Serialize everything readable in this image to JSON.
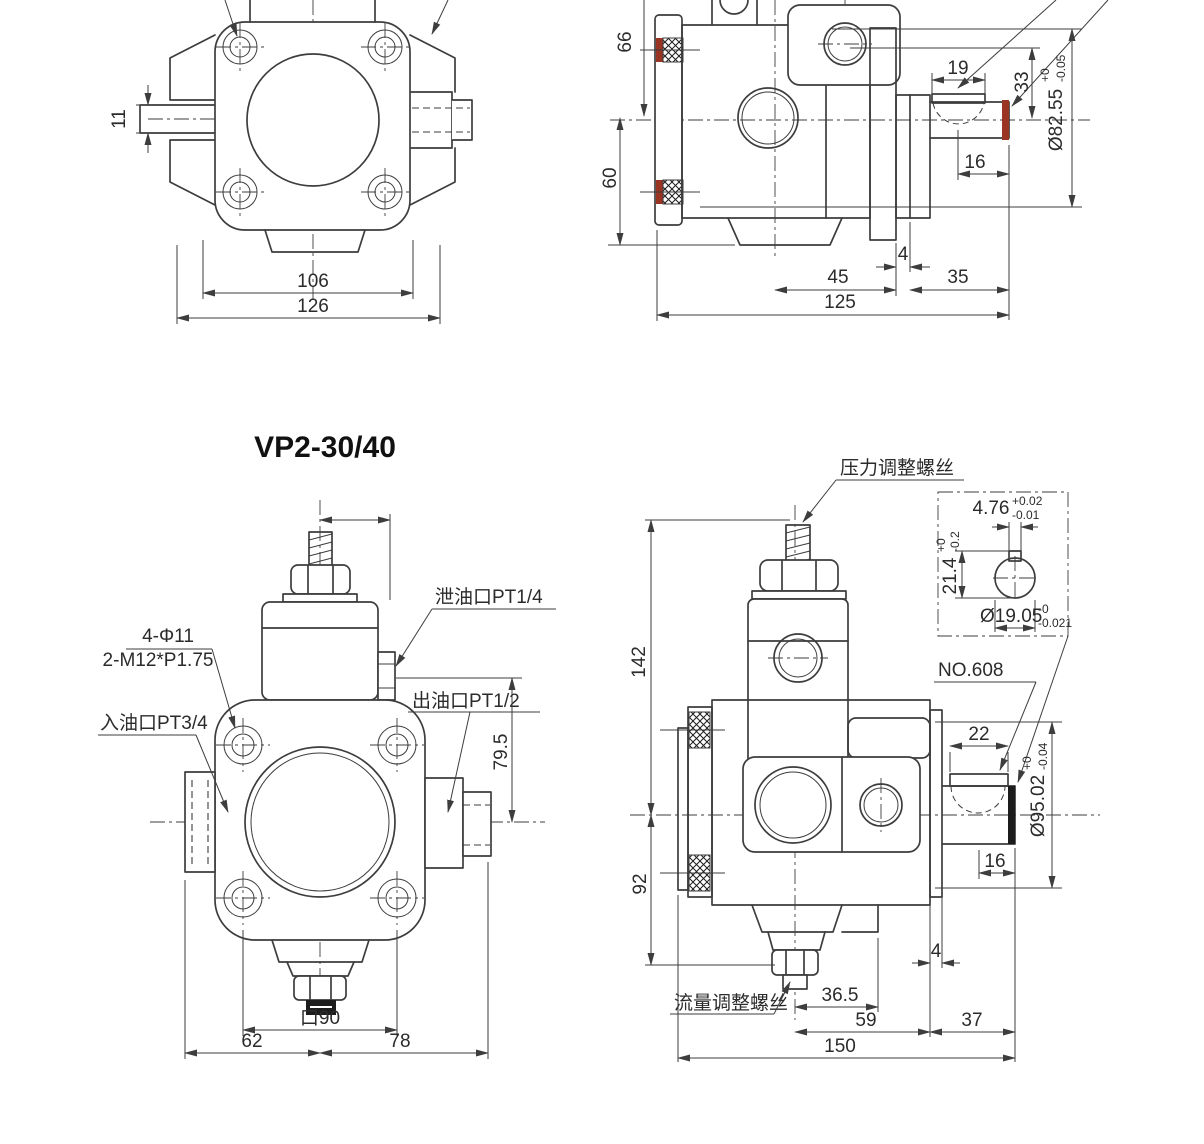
{
  "title": "VP2-30/40",
  "colors": {
    "line": "#3d3d3d",
    "text": "#2b2b2b",
    "seal_red": "#993522",
    "hatch_black": "#1c1c1c",
    "background": "#ffffff"
  },
  "views": {
    "top_front": {
      "dims": {
        "stub_height": "11",
        "flange_width": "106",
        "overall_width": "126"
      }
    },
    "top_side": {
      "dims": {
        "upper_height": "66",
        "lower_height": "60",
        "key_length": "19",
        "key_height": "33",
        "key_to_end": "16",
        "center_to_rear": "45",
        "rear_cover": "4",
        "shaft_ext": "35",
        "overall_length": "125"
      },
      "pilot_dia": {
        "value": "Ø82.55",
        "tol_upper": "+0",
        "tol_lower": "-0.05"
      }
    },
    "bottom_front": {
      "labels": {
        "drain_port": "泄油口PT1/4",
        "mount_holes": "4-Φ11",
        "mount_threads": "2-M12*P1.75",
        "inlet_port": "入油口PT3/4",
        "outlet_port": "出油口PT1/2"
      },
      "dims": {
        "port_to_center": "79.5",
        "bolt_square": "口90",
        "left_of_center": "62",
        "right_of_center": "78"
      }
    },
    "bottom_side": {
      "labels": {
        "pressure_screw": "压力调整螺丝",
        "key_number": "NO.608",
        "flow_screw": "流量调整螺丝"
      },
      "dims": {
        "height_upper": "142",
        "height_lower": "92",
        "key_length": "22",
        "key_to_end": "16",
        "rear_cover": "4",
        "foot_offset": "36.5",
        "center_to_rear": "59",
        "shaft_ext": "37",
        "overall_length": "150"
      },
      "pilot_dia": {
        "value": "Ø95.02",
        "tol_upper": "+0",
        "tol_lower": "-0.04"
      },
      "shaft_detail": {
        "key_width": "4.76",
        "key_width_tol_upper": "+0.02",
        "key_width_tol_lower": "-0.01",
        "height": "21.4",
        "height_tol_upper": "+0",
        "height_tol_lower": "-0.2",
        "diameter": "Ø19.05",
        "diameter_tol_upper": "-0",
        "diameter_tol_lower": "-0.021"
      }
    }
  }
}
